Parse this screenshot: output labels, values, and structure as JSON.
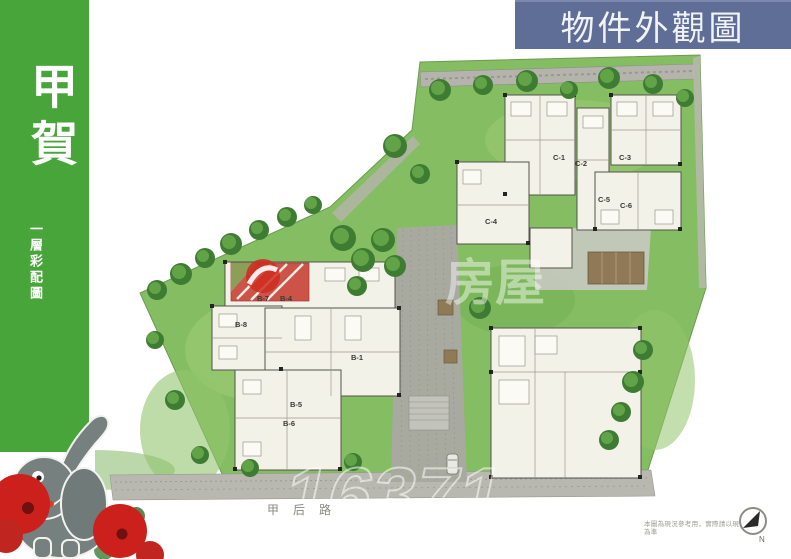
{
  "palette": {
    "sidebar_green": "#48a53a",
    "title_bar_blue": "#5e6e96",
    "grass_green": "#85bd62",
    "road_gray": "#a8aaa0",
    "building_fill": "#f3f2e9",
    "flower_red": "#cc201c",
    "watermark_white": "#ffffff"
  },
  "sidebar": {
    "title_vertical": "甲賀",
    "subtitle_vertical": "一層彩配圖"
  },
  "header": {
    "title": "物件外觀圖"
  },
  "plan": {
    "buildings": [
      {
        "label": "C-1"
      },
      {
        "label": "C-2"
      },
      {
        "label": "C-3"
      },
      {
        "label": "C-4"
      },
      {
        "label": "C-5"
      },
      {
        "label": "C-6"
      },
      {
        "label": "B-7"
      },
      {
        "label": "B-4"
      },
      {
        "label": "B-8"
      },
      {
        "label": "B-1"
      },
      {
        "label": "B-5"
      },
      {
        "label": "B-6"
      }
    ],
    "road_label": "甲后路",
    "watermark_text": "房屋",
    "watermark_number": "16371",
    "disclaimer": "本圖為現況參考用，實際請以現場為準",
    "compass_label": "N"
  }
}
